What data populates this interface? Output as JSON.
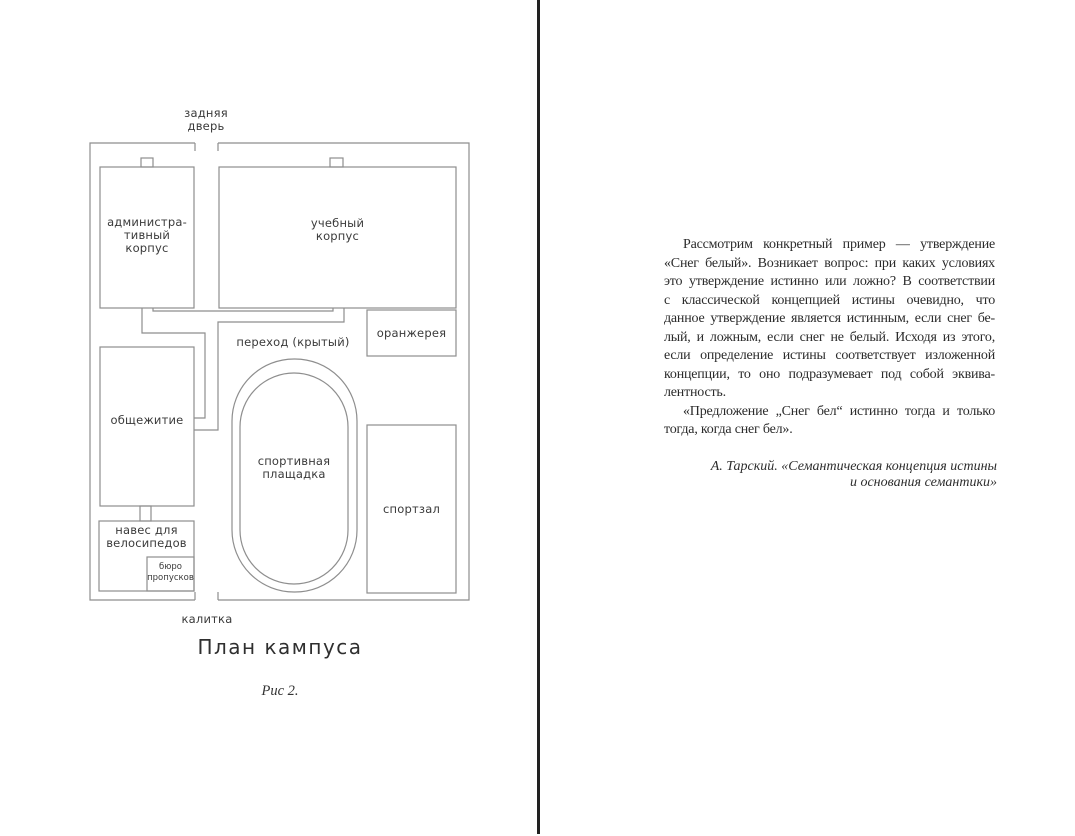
{
  "left_page": {
    "figure": {
      "back_door_label": "задняя\nдверь",
      "gate_label": "калитка",
      "buildings": {
        "admin": "администра-\nтивный\nкорпус",
        "academic": "учебный\nкорпус",
        "greenhouse": "оранжерея",
        "walkway": "переход (крытый)",
        "dormitory": "общежитие",
        "sports_field": "спортивная\nплащадка",
        "gym": "спортзал",
        "bike_shed": "навес для\nвелосипедов",
        "pass_office": "бюро\nпропусков"
      },
      "caption": "План кампуса",
      "figure_number": "Рис 2."
    }
  },
  "right_page": {
    "body_lines": [
      "Рассмотрим конкретный пример — утверждение",
      "«Снег белый». Возникает вопрос: при каких условиях",
      "это утверждение истинно или ложно? В соответствии",
      "с классической концепцией истины очевидно, что",
      "данное утверждение является истинным, если снег бе-",
      "лый, и ложным, если снег не белый. Исходя из этого,",
      "если определение истины соответствует изложенной",
      "концепции, то оно подразумевает под собой эквива-",
      "лентность.",
      "«Предложение „Снег бел“ истинно тогда и только",
      "тогда, когда снег бел»."
    ],
    "attribution": {
      "line1": "А. Тарский. «Семантическая концепция истины",
      "line2": "и основания семантики»"
    }
  },
  "colors": {
    "divider": "#212121",
    "diagram_line": "#8e8e8e",
    "diagram_text": "#3a3a3a",
    "body_text": "#2b2b2b"
  }
}
